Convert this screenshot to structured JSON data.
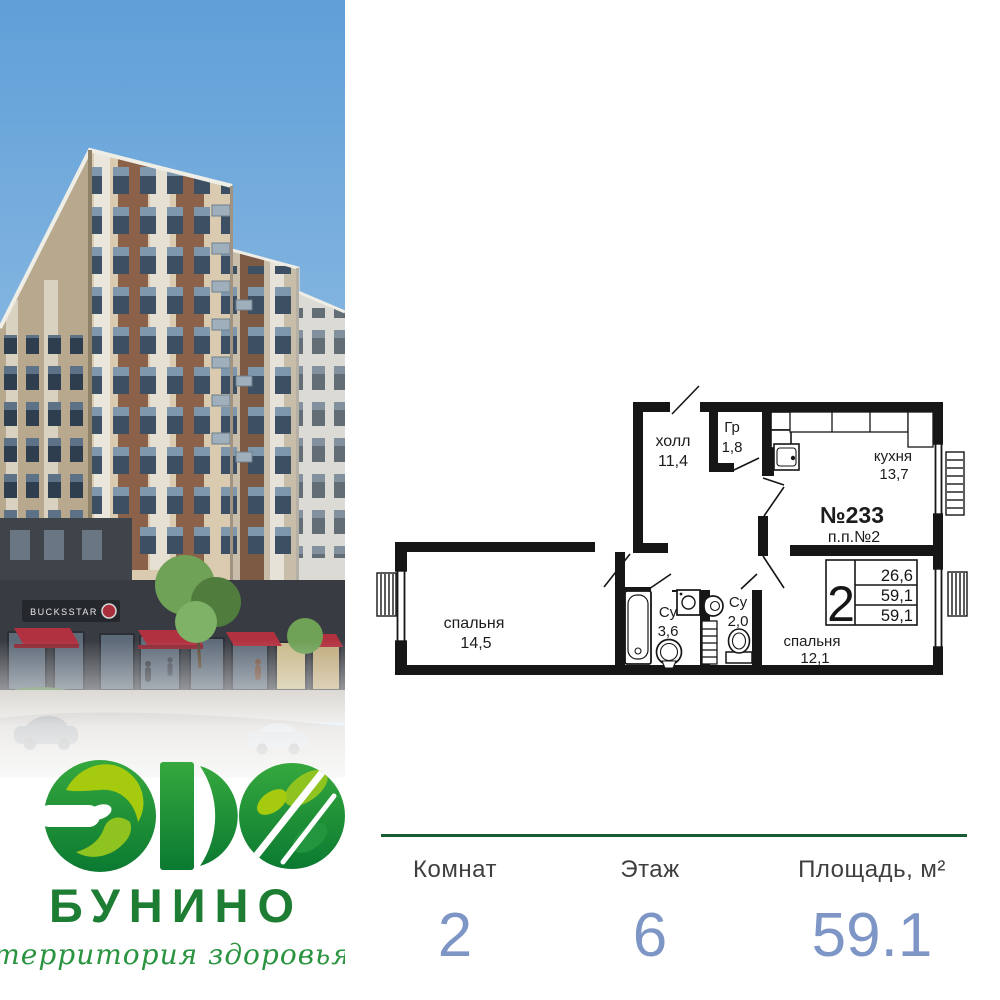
{
  "brand": {
    "logo_text": "ЭКО",
    "name": "БУНИНО",
    "tagline": "территория здоровья",
    "storefront_sign": "BUCKSSTAR"
  },
  "floor_plan": {
    "apartment_number": "№233",
    "project_note": "п.п.№2",
    "rooms": [
      {
        "name": "холл",
        "area": "11,4"
      },
      {
        "name": "Гр",
        "area": "1,8"
      },
      {
        "name": "кухня",
        "area": "13,7"
      },
      {
        "name": "спальня",
        "area": "14,5"
      },
      {
        "name": "Су",
        "area": "3,6"
      },
      {
        "name": "Су",
        "area": "2,0"
      },
      {
        "name": "спальня",
        "area": "12,1"
      }
    ],
    "summary_table": {
      "rooms_count": "2",
      "values": [
        "26,6",
        "59,1",
        "59,1"
      ]
    }
  },
  "stats": {
    "items": [
      {
        "label": "Комнат",
        "value": "2"
      },
      {
        "label": "Этаж",
        "value": "6"
      },
      {
        "label": "Площадь, м²",
        "value": "59.1"
      }
    ]
  },
  "colors": {
    "brand_green": "#1d7d33",
    "logo_lime": "#a6ca0e",
    "divider_green": "#175c33",
    "stat_value_blue": "#7e96c6",
    "awning_red": "#b13140"
  }
}
